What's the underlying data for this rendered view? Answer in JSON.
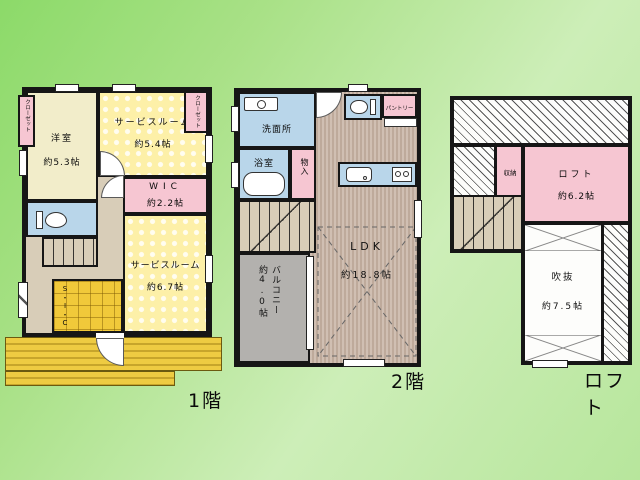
{
  "f1": {
    "label": "1階",
    "closet_left": "クローゼット",
    "yoshitsu_name": "洋室",
    "yoshitsu_size": "約5.3帖",
    "service1_name": "サービスルーム",
    "service1_size": "約5.4帖",
    "closet_right": "クローゼット",
    "wic_name": "WIC",
    "wic_size": "約2.2帖",
    "sic": "S・I・C",
    "service2_name": "サービスルーム",
    "service2_size": "約6.7帖"
  },
  "f2": {
    "label": "2階",
    "washroom": "洗面所",
    "bathroom": "浴室",
    "storage": "物入",
    "pantry": "パントリー",
    "ldk_name": "LDK",
    "ldk_size": "約18.8帖",
    "balcony_name": "バルコニー",
    "balcony_size": "約4.0帖"
  },
  "loft": {
    "label": "ロフト",
    "storage": "収納",
    "loft_name": "ロフト",
    "loft_size": "約6.2帖",
    "void_name": "吹抜",
    "void_size": "約7.5帖"
  },
  "colors": {
    "background_green": "#a8e18a",
    "wall": "#161616",
    "room_pink": "#f6c6d2",
    "room_blue": "#b9d6ea",
    "room_cream": "#f2edca",
    "room_yellow": "#fdf0a8",
    "wood_floor": "#c9b6a8",
    "balcony_gray": "#b3b1ae",
    "deck_yellow": "#e8c53a"
  }
}
